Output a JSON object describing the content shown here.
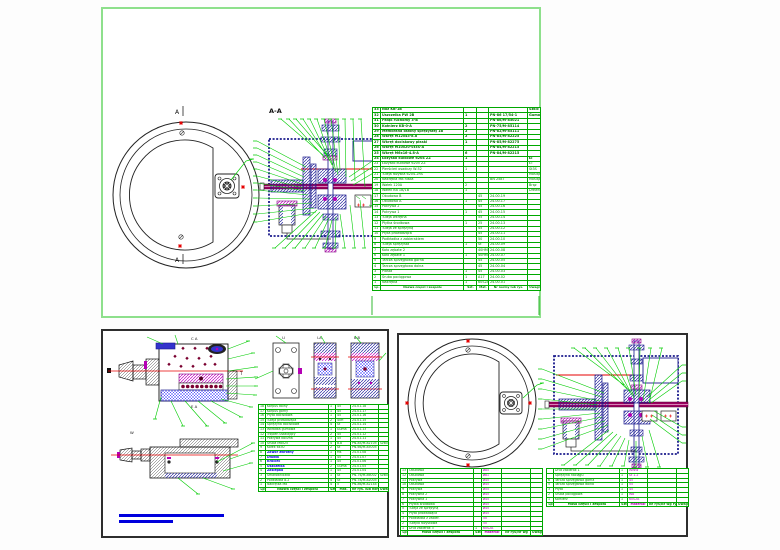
{
  "colors": {
    "cad_green": "#00b400",
    "navy": "#1a1a8c",
    "magenta": "#b400b4",
    "red": "#e60000",
    "bar_blue": "#0000dd",
    "shaft_red": "#9c0060",
    "sheet_border_green": "#8ee08c"
  },
  "top_sheet": {
    "section_title": "A-A",
    "cut_label_top": "A",
    "cut_label_bottom": "A",
    "bom": {
      "rows": [
        {
          "c": [
            "33",
            "Nóż KB-1B",
            "",
            "",
            "",
            "Szkic"
          ],
          "cls": "b"
        },
        {
          "c": [
            "32",
            "Uszczelka PW 2B",
            "1",
            "",
            "PN-86 17/54-1",
            "Gumolit"
          ],
          "cls": "b"
        },
        {
          "c": [
            "31",
            "Pałąk ruchomy 3-B",
            "",
            "",
            "PN-86/M-85021",
            ""
          ],
          "cls": "b"
        },
        {
          "c": [
            "30",
            "Kołnierz KB-0-A",
            "2",
            "",
            "PN-75/M-85114",
            ""
          ],
          "cls": "b"
        },
        {
          "c": [
            "29",
            "Membrana osłony sprężystej 1B",
            "2",
            "",
            "PN-82/M-85111",
            ""
          ],
          "cls": "b"
        },
        {
          "c": [
            "28",
            "Wkręt M12x45-8.8",
            "2",
            "",
            "PN-85/M-82225",
            ""
          ],
          "cls": "b"
        },
        {
          "c": [
            "27",
            "Wkręt dociskowy płaski",
            "1",
            "",
            "PN-85/M-82275",
            ""
          ],
          "cls": "b"
        },
        {
          "c": [
            "26",
            "Wkręt M10x20-St3S-A",
            "",
            "",
            "PN-84/M-82215",
            ""
          ],
          "cls": "b"
        },
        {
          "c": [
            "25",
            "Wkręt M6x16-4.8-A",
            "6",
            "",
            "PN-84/M-82215",
            ""
          ],
          "cls": "b"
        },
        {
          "c": [
            "24",
            "Łożysko kulkowe 6204 ZZ",
            "1",
            "",
            "",
            "ŁT"
          ],
          "cls": "b"
        },
        {
          "c": [
            "23",
            "Łożysko kulkowe 6205 ZZ",
            "",
            "",
            "",
            "ŁT"
          ]
        },
        {
          "c": [
            "22",
            "Pierścień osadczy W-52",
            "1",
            "",
            "",
            "St3S"
          ]
        },
        {
          "c": [
            "21",
            "Tuleja łożyska 6204-2RS",
            "",
            "",
            "",
            "Mosiądz"
          ]
        },
        {
          "c": [
            "20",
            "Nakrętka M8 niska",
            "",
            "",
            "BN 2587",
            "Mosiądz"
          ]
        },
        {
          "c": [
            "19",
            "Wałek 120A",
            "2",
            "",
            "",
            "Brąz"
          ]
        },
        {
          "c": [
            "18",
            "Wałek KB 1B/1B",
            "1",
            "",
            "",
            "Drewno"
          ]
        },
        {
          "c": [
            "17",
            "Obudowa B",
            "",
            "45",
            "24.00.19",
            ""
          ]
        },
        {
          "c": [
            "16",
            "Obudowa A",
            "1",
            "45",
            "24.00.17",
            ""
          ]
        },
        {
          "c": [
            "15",
            "Pokrywa 2",
            "",
            "45",
            "24.00.16",
            ""
          ]
        },
        {
          "c": [
            "14",
            "Pokrywa 1",
            "1",
            "45",
            "24.00.15",
            ""
          ]
        },
        {
          "c": [
            "13",
            "Tuleja wkrętna",
            "",
            "55",
            "24.00.14",
            ""
          ]
        },
        {
          "c": [
            "12",
            "Płytka środkowa",
            "1",
            "25",
            "24.00.13",
            ""
          ]
        },
        {
          "c": [
            "11",
            "Tuleja ze sprężyną",
            "",
            "45",
            "24.00.12",
            ""
          ]
        },
        {
          "c": [
            "10",
            "Płyta prowadząca",
            "",
            "45",
            "24.00.11",
            ""
          ]
        },
        {
          "c": [
            "9",
            "Podkładka z zabierakiem",
            "",
            "50",
            "24.00.10",
            ""
          ]
        },
        {
          "c": [
            "8",
            "Tuleja sprężysta",
            "1",
            "St",
            "24.00.09",
            ""
          ]
        },
        {
          "c": [
            "7",
            "Koło zębate 2",
            "",
            "40HM",
            "24.00.08",
            ""
          ]
        },
        {
          "c": [
            "6",
            "Koło zębate 1",
            "1",
            "40HM",
            "24.00.07",
            ""
          ]
        },
        {
          "c": [
            "5",
            "Tarcza sprzęgłowa górna",
            "",
            "45",
            "24.00.05",
            ""
          ]
        },
        {
          "c": [
            "4",
            "Tarcza sprzęgłowa dolna",
            "",
            "45",
            "24.00.04",
            ""
          ]
        },
        {
          "c": [
            "3",
            "Piasta",
            "1",
            "45",
            "24.00.03",
            ""
          ]
        },
        {
          "c": [
            "2",
            "Śruba pociągowa",
            "1",
            "A17",
            "24.00.02",
            ""
          ]
        },
        {
          "c": [
            "1",
            "Nakrętka",
            "1",
            "60S2A",
            "24.00.01",
            ""
          ]
        },
        {
          "c": [
            "Lp.",
            "Nazwa części i zespołu",
            "Szt.",
            "Mat.",
            "Nr normy lub rys.",
            "Uwagi"
          ],
          "cls": "foot"
        }
      ]
    }
  },
  "bottom_left": {
    "labels": {
      "top": "C  A",
      "bottom": "E  A",
      "t": "T",
      "w": "W",
      "view_plate": "I-I",
      "view1": "I-A",
      "view2": "B-B"
    },
    "bom": {
      "rows": [
        {
          "c": [
            "18",
            "Korpus dolny",
            "1",
            "45",
            "24.01.18",
            ""
          ]
        },
        {
          "c": [
            "17",
            "Korpus górny",
            "1",
            "45",
            "24.01.17",
            ""
          ]
        },
        {
          "c": [
            "16",
            "Płyta dociskowa",
            "1",
            "45",
            "24.01.16",
            ""
          ]
        },
        {
          "c": [
            "15",
            "Tuleja prowadząca",
            "2",
            "40H",
            "24.01.15",
            ""
          ]
        },
        {
          "c": [
            "14",
            "Sprężyna dociskowa",
            "4",
            "St",
            "24.01.14",
            ""
          ]
        },
        {
          "c": [
            "13",
            "Wkładka gumowa",
            "1",
            "Guma",
            "24.01.13",
            ""
          ]
        },
        {
          "c": [
            "12",
            "Trzpień ustalający",
            "2",
            "45",
            "24.01.12",
            ""
          ]
        },
        {
          "c": [
            "11",
            "Pokrywa boczna",
            "1",
            "45",
            "24.01.11",
            ""
          ]
        },
        {
          "c": [
            "10",
            "Śruba M8x25",
            "4",
            "8.8",
            "PN-85/M-82105",
            "Szkic"
          ]
        },
        {
          "c": [
            "9",
            "Kołek 6x30",
            "2",
            "St",
            "PN-66/M-85005",
            ""
          ]
        },
        {
          "c": [
            "8",
            "Zawór zwrotny",
            "1",
            "Ms",
            "24.01.08",
            ""
          ],
          "cls": "blue"
        },
        {
          "c": [
            "7",
            "Dławik",
            "1",
            "45",
            "24.01.07",
            ""
          ],
          "cls": "blue"
        },
        {
          "c": [
            "6",
            "Króciec",
            "1",
            "45",
            "24.01.06",
            ""
          ],
          "cls": "blue"
        },
        {
          "c": [
            "5",
            "Uszczelka",
            "2",
            "Guma",
            "24.01.05",
            ""
          ],
          "cls": "blue"
        },
        {
          "c": [
            "4",
            "Zaślepka",
            "1",
            "45",
            "24.01.04",
            ""
          ],
          "cls": "blue"
        },
        {
          "c": [
            "3",
            "Smarowniczka",
            "1",
            "St",
            "PN-76/M-86002",
            "Szkic"
          ]
        },
        {
          "c": [
            "2",
            "Podkładka 8.2",
            "4",
            "St",
            "PN-78/M-82005",
            ""
          ]
        },
        {
          "c": [
            "1",
            "Nakrętka M8",
            "4",
            "5",
            "PN-86/M-82144",
            ""
          ]
        },
        {
          "c": [
            "Lp",
            "Nazwa części i zespołu",
            "Szt",
            "Mat.",
            "Nr rys. lub normy",
            "Uwagi"
          ],
          "cls": "foot"
        }
      ]
    }
  },
  "bottom_right": {
    "left_table": {
      "rows": [
        {
          "c": [
            "13",
            "Obudowa",
            "",
            "ø85",
            "",
            ""
          ]
        },
        {
          "c": [
            "12",
            "Obudowa",
            "",
            "ø81",
            "",
            ""
          ]
        },
        {
          "c": [
            "11",
            "Pokrywa",
            "",
            "ø45",
            "",
            ""
          ]
        },
        {
          "c": [
            "10",
            "Obudowa",
            "",
            "ø45",
            "",
            ""
          ]
        },
        {
          "c": [
            "9",
            "Pokrywa",
            "",
            "ø55",
            "",
            ""
          ]
        },
        {
          "c": [
            "8",
            "Pokrywka 2",
            "",
            "ø45",
            "",
            ""
          ]
        },
        {
          "c": [
            "7",
            "Pokrywka 1",
            "",
            "ø45",
            "",
            ""
          ]
        },
        {
          "c": [
            "6",
            "Płytka środkowa",
            "",
            "ø45",
            "",
            ""
          ]
        },
        {
          "c": [
            "5",
            "Tuleja ze sprężyną",
            "",
            "ø45",
            "",
            ""
          ]
        },
        {
          "c": [
            "4",
            "Płyta prowadząca",
            "",
            "ø45",
            "",
            ""
          ]
        },
        {
          "c": [
            "3",
            "Podkładka z zabier.",
            "",
            "50",
            "",
            ""
          ]
        },
        {
          "c": [
            "2",
            "Tulejka łożyskowa",
            "",
            "50",
            "",
            ""
          ]
        },
        {
          "c": [
            "1",
            "Drut zabierak 3",
            "1",
            "60S2A",
            "",
            ""
          ]
        },
        {
          "c": [
            "Lp",
            "Masa części i zespołu",
            "Szt",
            "Materiał",
            "Nr rys/Nr wg",
            "Uwagi"
          ],
          "cls": "foot"
        }
      ]
    },
    "right_table": {
      "rows": [
        {
          "c": [
            "",
            "Drut zabierak 1",
            "1",
            "WWW",
            "",
            ""
          ]
        },
        {
          "c": [
            "",
            "Sprężyna naciągu",
            "1",
            "St 1.2",
            "",
            ""
          ]
        },
        {
          "c": [
            "6",
            "Tarcza sprzęgłowa górna",
            "1",
            "45",
            "",
            ""
          ]
        },
        {
          "c": [
            "5",
            "Tarcza sprzęgłowa dolna",
            "1",
            "55",
            "",
            ""
          ]
        },
        {
          "c": [
            "3",
            "Płyta",
            "1",
            "45",
            "",
            ""
          ]
        },
        {
          "c": [
            "2",
            "Śruba pociągowa",
            "1",
            "W8",
            "",
            ""
          ]
        },
        {
          "c": [
            "1",
            "Kołnierz",
            "1",
            "60S2A",
            "",
            ""
          ]
        },
        {
          "c": [
            "Lp",
            "Masa części i zespołu",
            "Szt",
            "Materiał",
            "Nr rys/Nr wg rys.",
            "Uwagi"
          ],
          "cls": "foot"
        }
      ]
    }
  }
}
